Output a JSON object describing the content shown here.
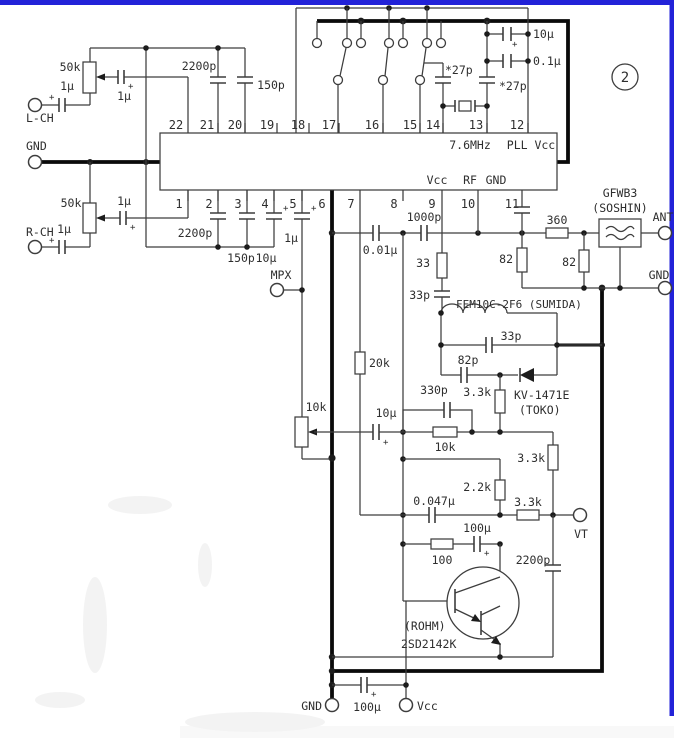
{
  "badge": {
    "number": "2"
  },
  "ic": {
    "pins_top": [
      "22",
      "21",
      "20",
      "19",
      "18",
      "17",
      "16",
      "15",
      "14",
      "13",
      "12"
    ],
    "pins_bottom": [
      "1",
      "2",
      "3",
      "4",
      "5",
      "6",
      "7",
      "8",
      "9",
      "10",
      "11"
    ],
    "internal": {
      "xtal_freq": "7.6MHz",
      "pll_vcc": "PLL Vcc",
      "vcc": "Vcc",
      "rf": "RF",
      "gnd": "GND"
    }
  },
  "terminals": {
    "lch": "L-CH",
    "gnd_left": "GND",
    "rch": "R-CH",
    "mpx": "MPX",
    "ant": "ANT",
    "gnd_right": "GND",
    "gnd_bottom": "GND",
    "vcc_bottom": "Vcc",
    "vt": "VT",
    "gnd_center": "GND"
  },
  "components": {
    "pot_l": "50k",
    "cap_l_in": "1μ",
    "cap_l_wiper": "1μ",
    "cap_2200p_top": "2200p",
    "cap_150p_top": "150p",
    "pot_r": "50k",
    "cap_r_in": "1μ",
    "cap_r_wiper": "1μ",
    "cap_2200p_p2": "2200p",
    "cap_150p_p3": "150p",
    "cap_10u_p4": "10μ",
    "cap_1u_p5": "1μ",
    "cap_10u_pll": "10μ",
    "cap_01u_pll": "0.1μ",
    "xtal_cap_l": "*27p",
    "xtal_cap_r": "*27p",
    "cap_001u": "0.01μ",
    "cap_1000p": "1000p",
    "res_33": "33",
    "cap_33p_a": "33p",
    "ind_fem": "FEM10C-2F6 (SUMIDA)",
    "cap_33p_b": "33p",
    "cap_82p": "82p",
    "varactor_name": "KV-1471E",
    "varactor_maker": "(TOKO)",
    "res_360": "360",
    "res_82_a": "82",
    "res_82_b": "82",
    "filter_name": "GFWB3",
    "filter_maker": "(SOSHIN)",
    "res_20k": "20k",
    "pot_10k": "10k",
    "cap_10u_af": "10μ",
    "cap_330p": "330p",
    "res_10k": "10k",
    "res_33k_diode": "3.3k",
    "res_33k_right": "3.3k",
    "res_22k": "2.2k",
    "cap_0047u": "0.047μ",
    "res_33k_vt": "3.3k",
    "cap_100u_mid": "100μ",
    "res_100": "100",
    "cap_2200p_bot": "2200p",
    "tr_maker": "(ROHM)",
    "tr_part": "2SD2142K",
    "cap_100u_bot": "100μ"
  },
  "sym": {
    "plus": "+"
  }
}
